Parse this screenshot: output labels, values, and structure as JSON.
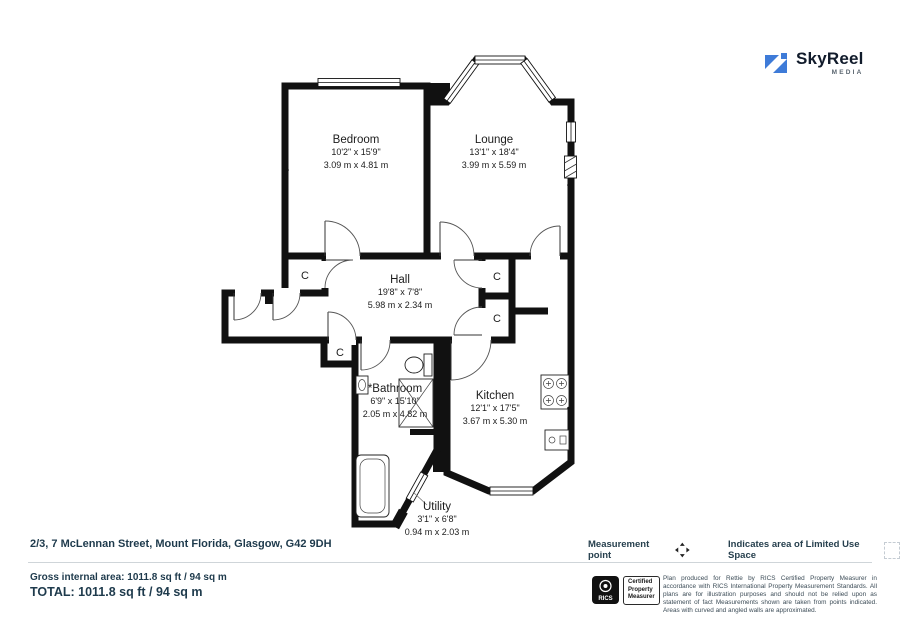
{
  "logo": {
    "brand": "SkyReel",
    "sub": "MEDIA",
    "accent_color": "#3E7BD8"
  },
  "plan": {
    "closet_label": "C",
    "rooms": [
      {
        "id": "bedroom",
        "name": "Bedroom",
        "imperial": "10'2\" x 15'9\"",
        "metric": "3.09 m x 4.81 m"
      },
      {
        "id": "lounge",
        "name": "Lounge",
        "imperial": "13'1\" x 18'4\"",
        "metric": "3.99 m x 5.59 m"
      },
      {
        "id": "hall",
        "name": "Hall",
        "imperial": "19'8\" x 7'8\"",
        "metric": "5.98 m x 2.34 m"
      },
      {
        "id": "bathroom",
        "name": "*Bathroom",
        "imperial": "6'9\" x 15'10\"",
        "metric": "2.05 m x 4.82 m"
      },
      {
        "id": "kitchen",
        "name": "Kitchen",
        "imperial": "12'1\" x 17'5\"",
        "metric": "3.67 m x 5.30 m"
      },
      {
        "id": "utility",
        "name": "Utility",
        "imperial": "3'1\" x 6'8\"",
        "metric": "0.94 m x 2.03 m"
      }
    ]
  },
  "footer": {
    "address": "2/3, 7 McLennan Street, Mount Florida, Glasgow, G42 9DH",
    "gross_area": "Gross internal area: 1011.8 sq ft / 94 sq m",
    "total": "TOTAL: 1011.8 sq ft / 94 sq m"
  },
  "legend": {
    "measurement_point": "Measurement point",
    "limited_use": "Indicates area of  Limited Use Space"
  },
  "rics": {
    "org": "RICS",
    "certified_lines": [
      "Certified",
      "Property",
      "Measurer"
    ],
    "disclaimer": "Plan produced for Rettie by RICS Certified Property Measurer in accordance with RICS International Property  Measurement Standards.  All plans are for illustration purposes and should not be relied upon as statement of fact Measurements shown are taken from points indicated. Areas with curved and angled walls are approximated."
  },
  "colors": {
    "wall": "#111111",
    "navy": "#1E3A4C",
    "accent": "#3E7BD8"
  }
}
